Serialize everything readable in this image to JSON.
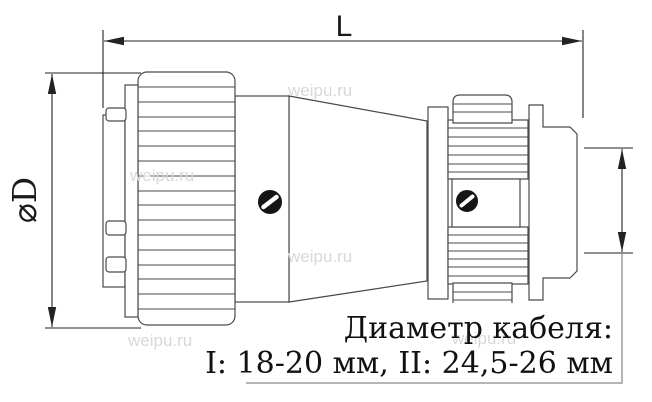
{
  "drawing": {
    "title": "connector side-view technical drawing",
    "labels": {
      "length": "L",
      "diameter": "⌀D"
    },
    "note": {
      "line1": "Диаметр кабеля:",
      "line2": "I: 18-20 мм, II: 24,5-26 мм"
    },
    "watermark": "weipu.ru",
    "colors": {
      "background": "#ffffff",
      "outline": "#4a4a4a",
      "dimension": "#222222",
      "screw_fill": "#151515",
      "watermark": "#d8d8d8",
      "note_box_border": "#b5b5b5",
      "text": "#111111"
    }
  }
}
